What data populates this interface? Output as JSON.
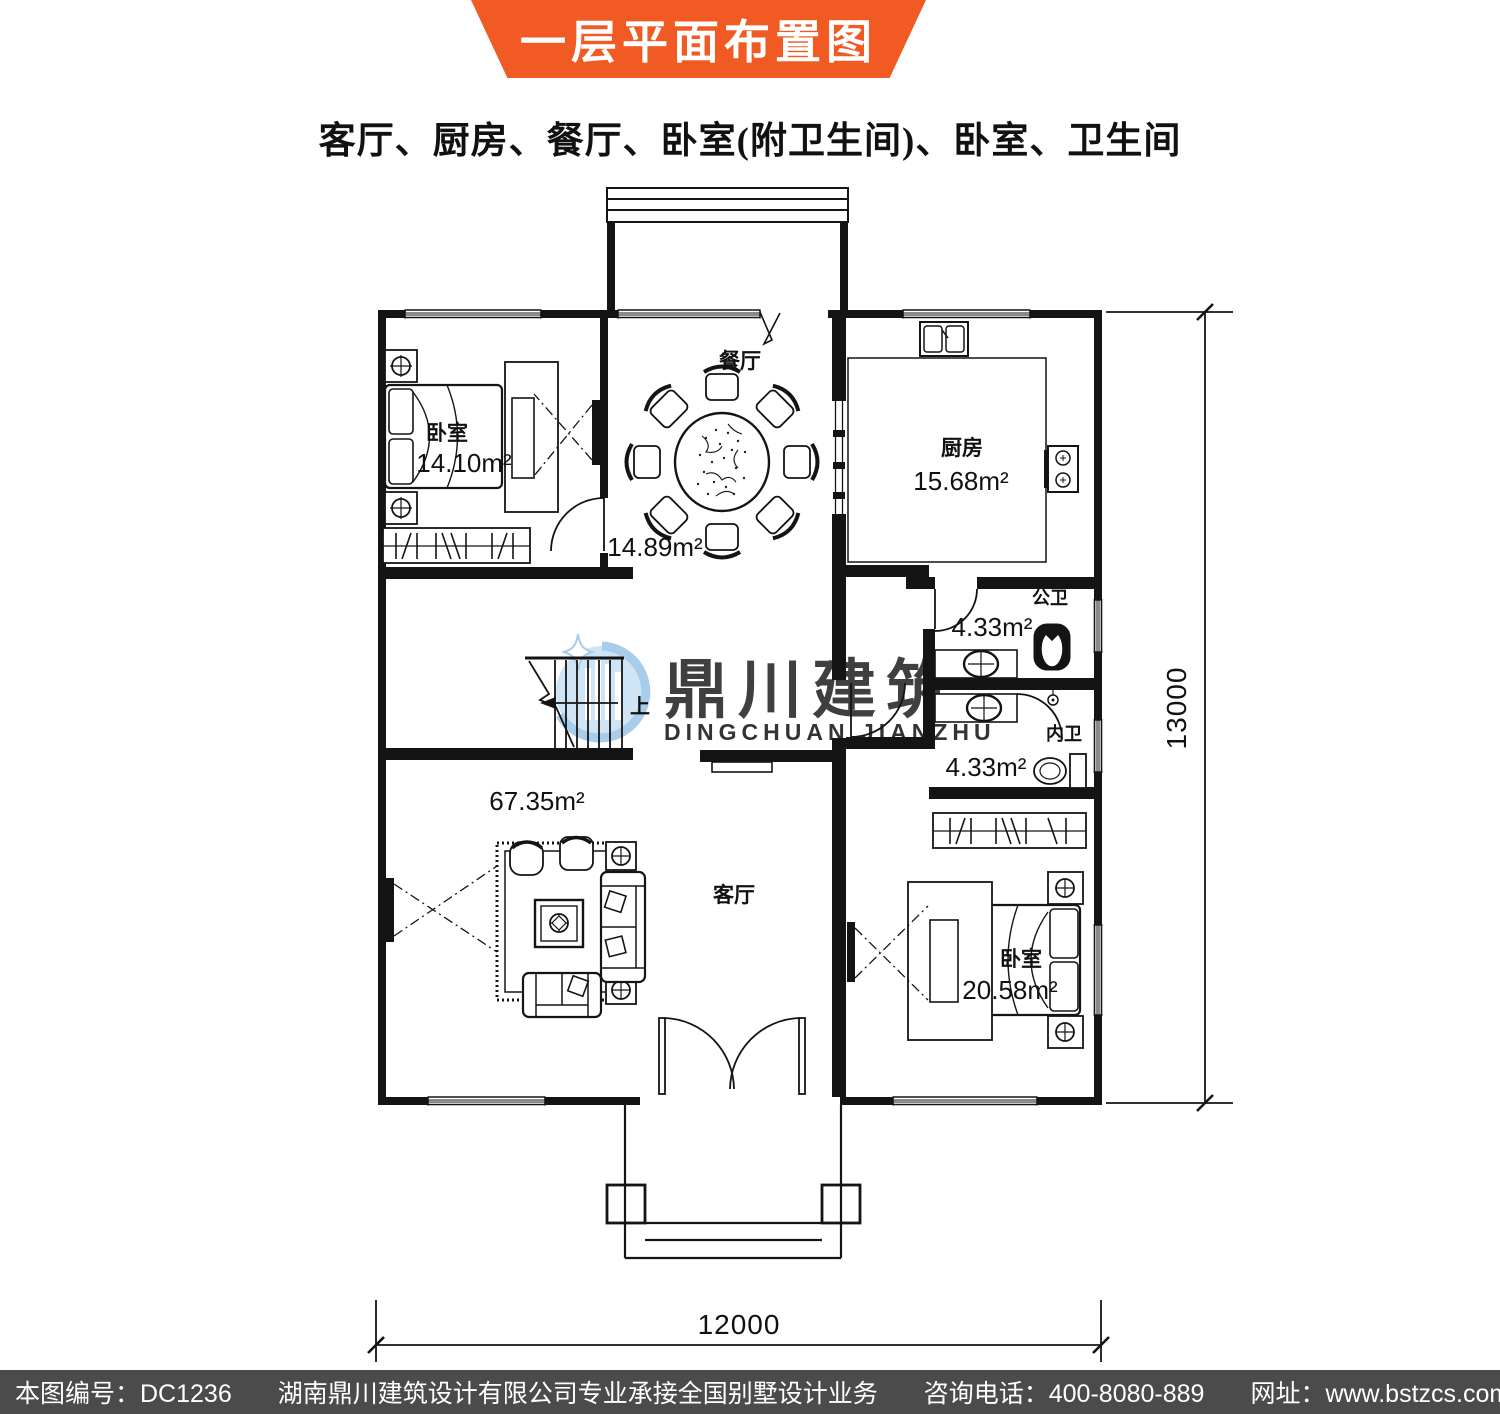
{
  "banner": {
    "title": "一层平面布置图",
    "bg": "#f15a22"
  },
  "subtitle": "客厅、厨房、餐厅、卧室(附卫生间)、卧室、卫生间",
  "plan": {
    "rooms": {
      "bedroom1": {
        "name": "卧室",
        "area": "14.10m²"
      },
      "dining": {
        "name": "餐厅",
        "area": "14.89m²"
      },
      "kitchen": {
        "name": "厨房",
        "area": "15.68m²"
      },
      "bath_public": {
        "name": "公卫",
        "area": "4.33m²"
      },
      "bath_private": {
        "name": "内卫",
        "area": "4.33m²"
      },
      "living": {
        "name": "客厅",
        "area": "67.35m²"
      },
      "bedroom2": {
        "name": "卧室",
        "area": "20.58m²"
      }
    },
    "stairs": {
      "up_label": "上"
    },
    "dimensions": {
      "height_mm": "13000",
      "width_mm": "12000"
    }
  },
  "watermark": {
    "name_cn": "鼎川建筑",
    "name_en": "DINGCHUAN JIANZHU"
  },
  "footer": {
    "drawing_no": "本图编号：DC1236",
    "company": "湖南鼎川建筑设计有限公司专业承接全国别墅设计业务",
    "phone": "咨询电话：400-8080-889",
    "website": "网址：www.bstzcs.com"
  }
}
